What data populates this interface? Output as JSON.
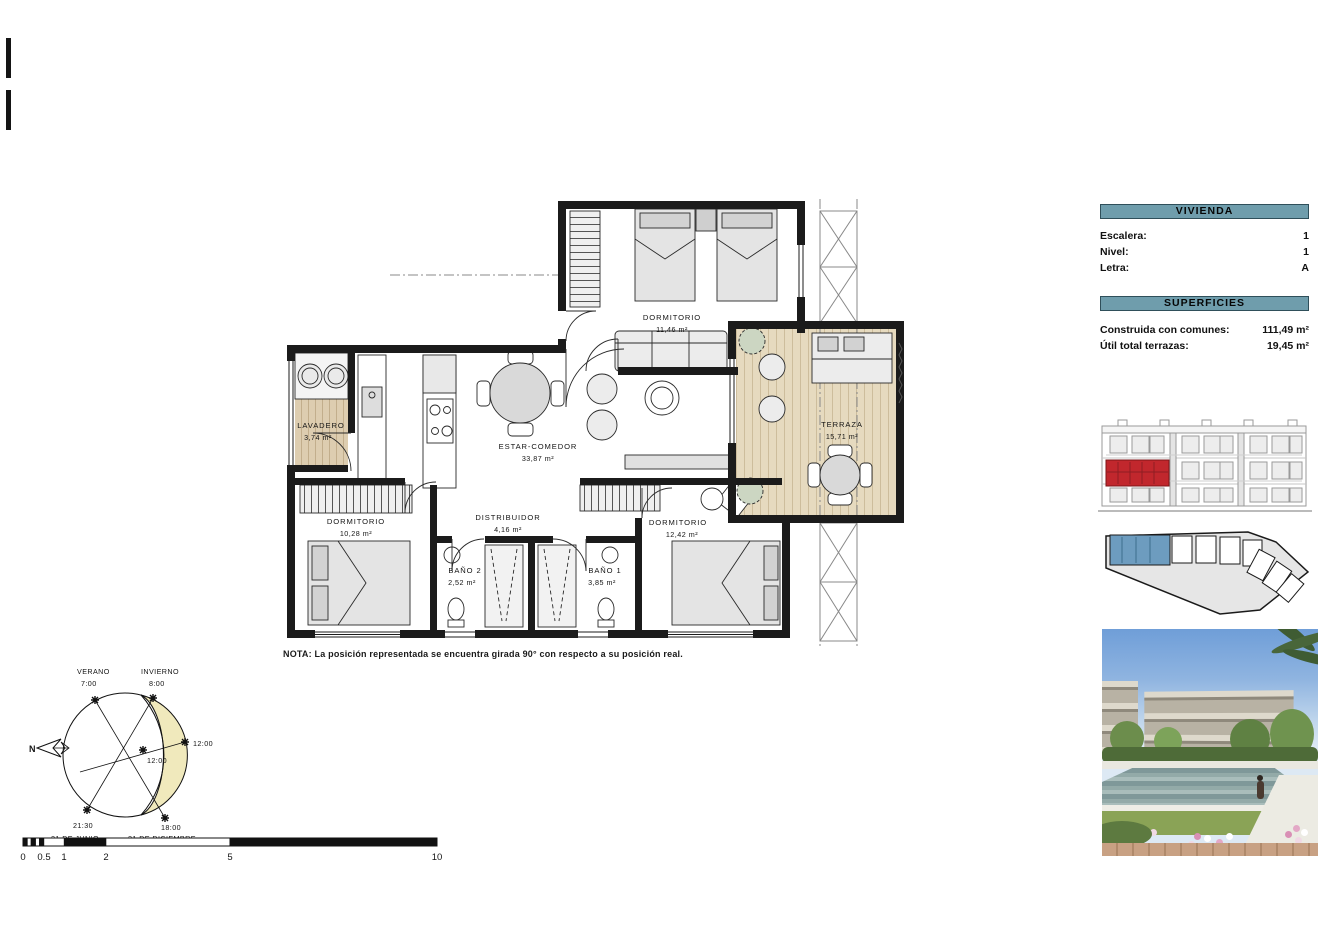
{
  "plan": {
    "note": "NOTA: La posición representada se encuentra girada 90° con respecto a su posición real.",
    "rooms": {
      "dormitorio1": {
        "name": "DORMITORIO",
        "area": "11,46 m²"
      },
      "lavadero": {
        "name": "LAVADERO",
        "area": "3,74 m²"
      },
      "estar": {
        "name": "ESTAR-COMEDOR",
        "area": "33,87 m²"
      },
      "terraza": {
        "name": "TERRAZA",
        "area": "15,71 m²"
      },
      "dormitorio2": {
        "name": "DORMITORIO",
        "area": "10,28 m²"
      },
      "distribuidor": {
        "name": "DISTRIBUIDOR",
        "area": "4,16 m²"
      },
      "bano2": {
        "name": "BAÑO 2",
        "area": "2,52 m²"
      },
      "bano1": {
        "name": "BAÑO 1",
        "area": "3,85 m²"
      },
      "dormitorio3": {
        "name": "DORMITORIO",
        "area": "12,42 m²"
      }
    }
  },
  "sun": {
    "verano": "VERANO",
    "verano_hora": "7:00",
    "invierno": "INVIERNO",
    "invierno_hora": "8:00",
    "mediodia_invierno": "12:00",
    "mediodia_verano": "12:00",
    "puesta_verano": "21:30",
    "puesta_invierno": "18:00",
    "fecha_verano": "21 DE JUNIO",
    "fecha_invierno": "21 DE DICIEMBRE",
    "norte": "N"
  },
  "scalebar": {
    "t0": "0",
    "t05": "0.5",
    "t1": "1",
    "t2": "2",
    "t5": "5",
    "t10": "10"
  },
  "panel": {
    "vivienda": {
      "title": "VIVIENDA",
      "rows": [
        {
          "label": "Escalera:",
          "value": "1"
        },
        {
          "label": "Nivel:",
          "value": "1"
        },
        {
          "label": "Letra:",
          "value": "A"
        }
      ]
    },
    "superficies": {
      "title": "SUPERFICIES",
      "rows": [
        {
          "label": "Construida con comunes:",
          "value": "111,49 m²"
        },
        {
          "label": "Útil total terrazas:",
          "value": "19,45 m²"
        }
      ]
    }
  },
  "colors": {
    "accent_bar": "#6f9dac",
    "unit_highlight_red": "#c1272d",
    "unit_highlight_blue": "#6d9cbf",
    "sun_fill": "#f0e9bc",
    "wood": "#ddcdb0"
  }
}
